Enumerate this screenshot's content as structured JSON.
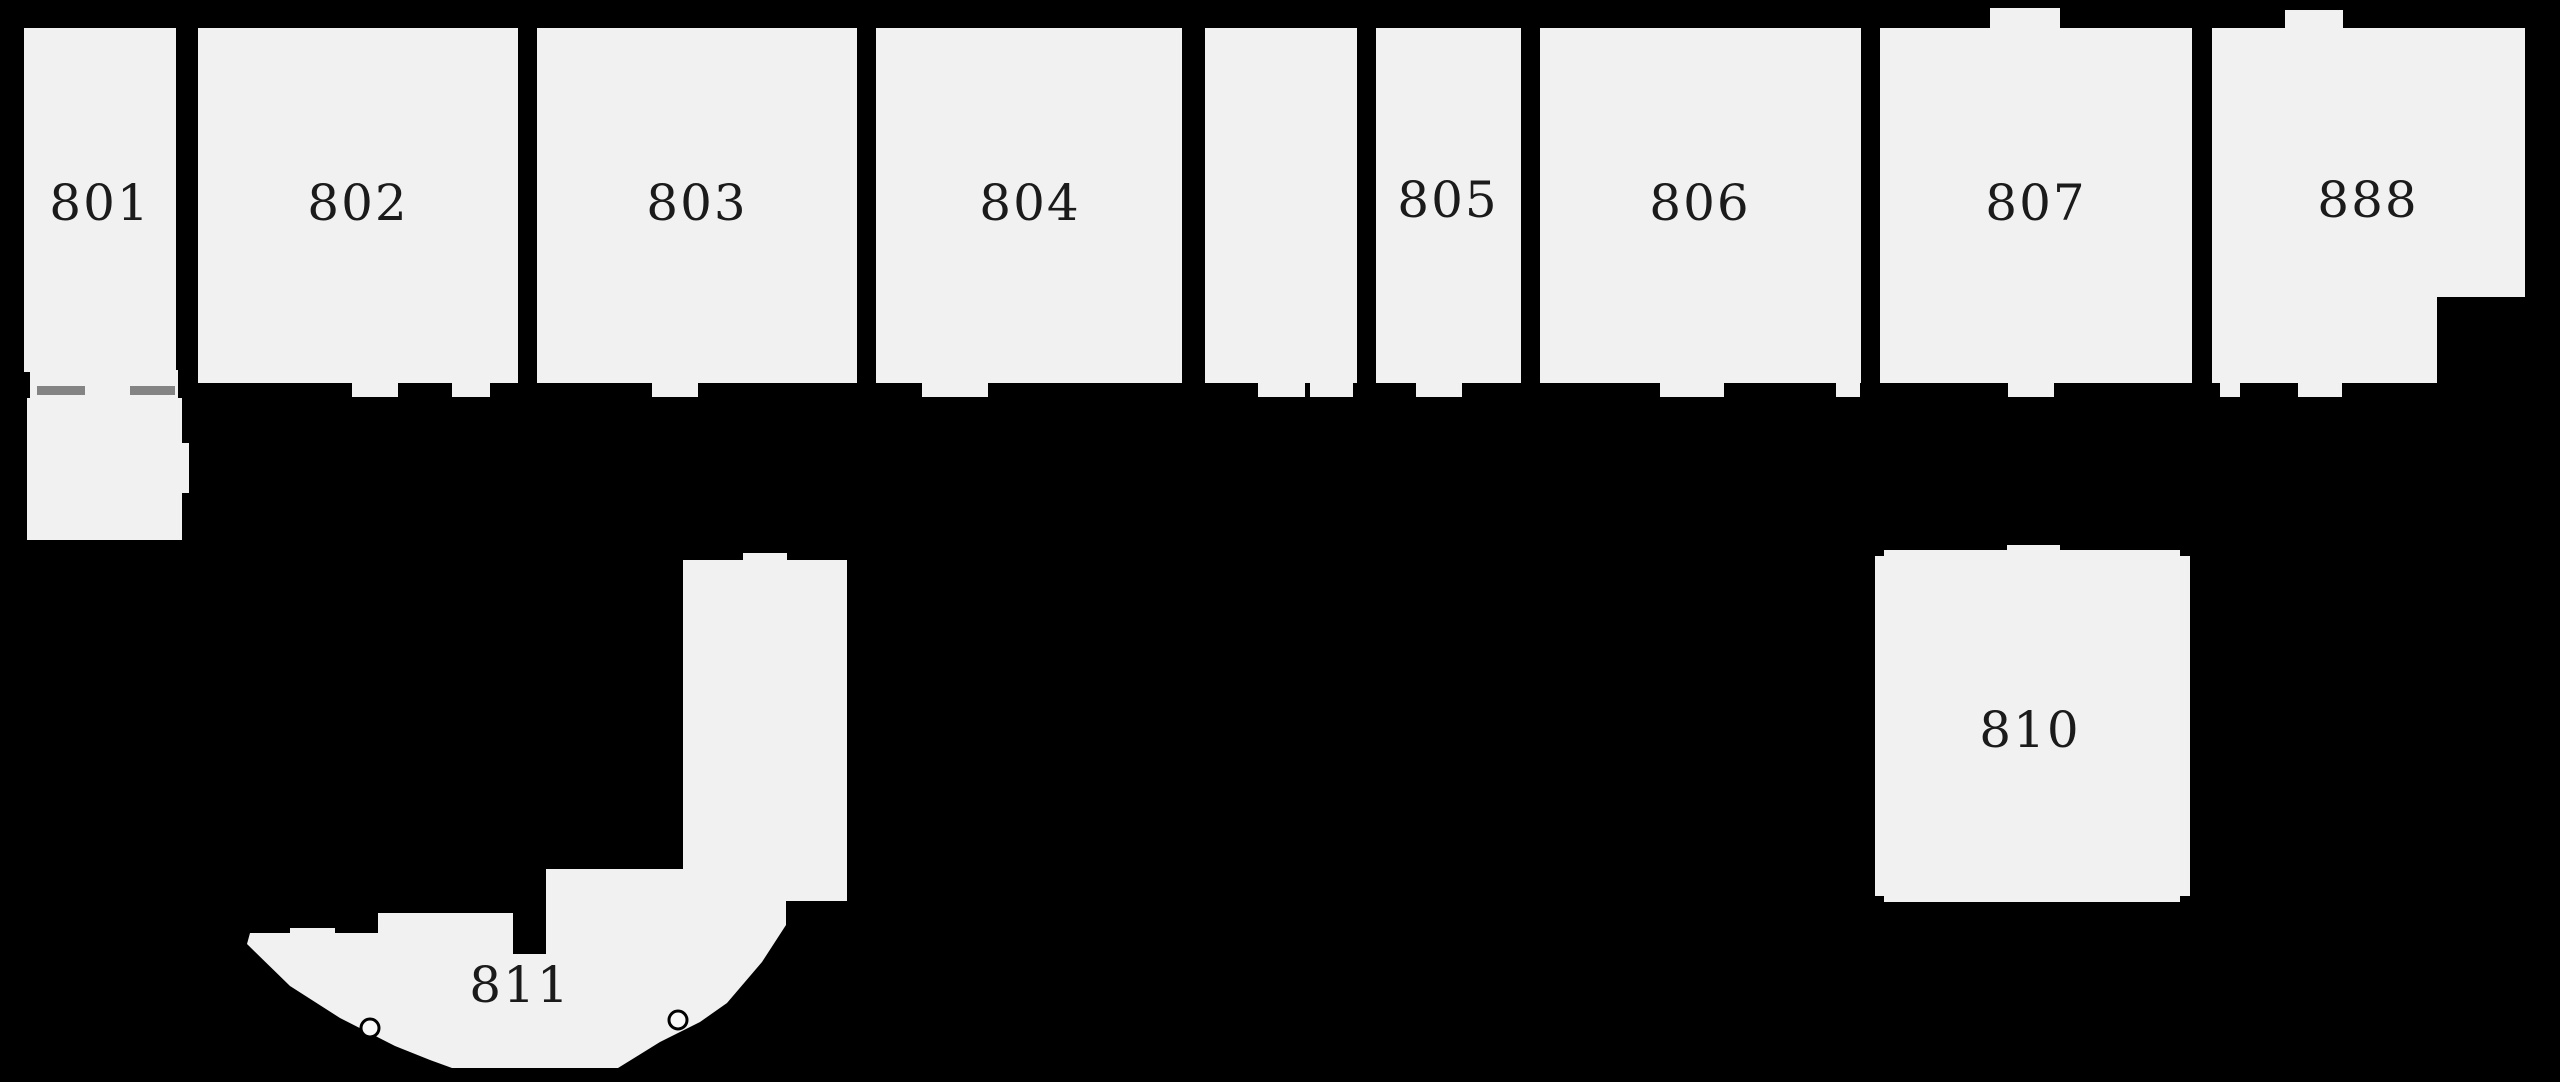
{
  "canvas": {
    "width": 2560,
    "height": 1082
  },
  "colors": {
    "background": "#000000",
    "room_fill": "#f1f1f1",
    "label": "#1b1b1b",
    "dash": "#848484",
    "knob_fill": "#f8f8f8",
    "knob_stroke": "#000000"
  },
  "label_font_size": 50,
  "rooms": [
    {
      "id": "room-801",
      "label": "801",
      "shape": "rect",
      "x": 24,
      "y": 28,
      "w": 152,
      "h": 344,
      "label_x": 100,
      "label_y": 203
    },
    {
      "id": "room-802",
      "label": "802",
      "shape": "rect",
      "x": 198,
      "y": 28,
      "w": 320,
      "h": 355,
      "label_x": 358,
      "label_y": 203
    },
    {
      "id": "room-803",
      "label": "803",
      "shape": "rect",
      "x": 537,
      "y": 28,
      "w": 320,
      "h": 355,
      "label_x": 697,
      "label_y": 203
    },
    {
      "id": "room-804",
      "label": "804",
      "shape": "rect",
      "x": 876,
      "y": 28,
      "w": 306,
      "h": 355,
      "label_x": 1030,
      "label_y": 203
    },
    {
      "id": "room-unlabeled",
      "label": "",
      "shape": "rect",
      "x": 1205,
      "y": 28,
      "w": 152,
      "h": 355
    },
    {
      "id": "room-805",
      "label": "805",
      "shape": "rect",
      "x": 1376,
      "y": 28,
      "w": 145,
      "h": 355,
      "label_x": 1448,
      "label_y": 200
    },
    {
      "id": "room-806",
      "label": "806",
      "shape": "rect",
      "x": 1540,
      "y": 28,
      "w": 321,
      "h": 355,
      "label_x": 1700,
      "label_y": 203
    },
    {
      "id": "room-807",
      "label": "807",
      "shape": "rect",
      "x": 1880,
      "y": 28,
      "w": 312,
      "h": 355,
      "label_x": 2036,
      "label_y": 203
    },
    {
      "id": "room-888",
      "label": "888",
      "shape": "polygon",
      "points": "2212,28 2525,28 2525,297 2437,297 2437,383 2212,383",
      "label_x": 2368,
      "label_y": 200
    },
    {
      "id": "room-801-annex",
      "label": "",
      "shape": "polygon",
      "points": "27,398 182,398 182,443 189,443 189,493 182,493 182,540 27,540"
    },
    {
      "id": "room-810",
      "label": "810",
      "shape": "polygon",
      "points": "1875,556 1884,556 1884,550 2007,550 2007,545 2060,545 2060,550 2180,550 2180,556 2190,556 2190,896 2180,896 2180,902 1884,902 1884,896 1875,896",
      "label_x": 2030,
      "label_y": 730
    },
    {
      "id": "room-811",
      "label": "811",
      "shape": "polygon",
      "points": "683,560 743,560 743,553 787,553 787,560 847,560 847,901 786,901 786,925 762,962 727,1003 700,1022 660,1042 618,1068 452,1068 430,1060 395,1046 340,1018 290,986 247,944 250,933 290,933 290,928 335,928 335,933 378,933 378,913 513,913 513,954 546,954 546,869 683,869",
      "label_x": 520,
      "label_y": 985
    }
  ],
  "door_openings": [
    {
      "x": 30,
      "y": 370,
      "w": 148,
      "h": 28
    },
    {
      "x": 352,
      "y": 378,
      "w": 46,
      "h": 19
    },
    {
      "x": 452,
      "y": 378,
      "w": 38,
      "h": 19
    },
    {
      "x": 652,
      "y": 378,
      "w": 46,
      "h": 19
    },
    {
      "x": 922,
      "y": 378,
      "w": 66,
      "h": 19
    },
    {
      "x": 1258,
      "y": 378,
      "w": 47,
      "h": 19
    },
    {
      "x": 1310,
      "y": 378,
      "w": 43,
      "h": 19
    },
    {
      "x": 1416,
      "y": 378,
      "w": 46,
      "h": 19
    },
    {
      "x": 1660,
      "y": 378,
      "w": 64,
      "h": 19
    },
    {
      "x": 1836,
      "y": 378,
      "w": 24,
      "h": 19
    },
    {
      "x": 2008,
      "y": 378,
      "w": 46,
      "h": 19
    },
    {
      "x": 2220,
      "y": 378,
      "w": 20,
      "h": 19
    },
    {
      "x": 2298,
      "y": 378,
      "w": 44,
      "h": 19
    }
  ],
  "top_tabs": [
    {
      "x": 1990,
      "y": 8,
      "w": 70,
      "h": 24
    },
    {
      "x": 2285,
      "y": 10,
      "w": 58,
      "h": 22
    }
  ],
  "door_dashes": [
    {
      "x": 37,
      "y": 386,
      "w": 48,
      "h": 9
    },
    {
      "x": 130,
      "y": 386,
      "w": 45,
      "h": 9
    }
  ],
  "door_knobs": [
    {
      "cx": 370,
      "cy": 1028,
      "r": 9
    },
    {
      "cx": 678,
      "cy": 1020,
      "r": 9
    }
  ]
}
